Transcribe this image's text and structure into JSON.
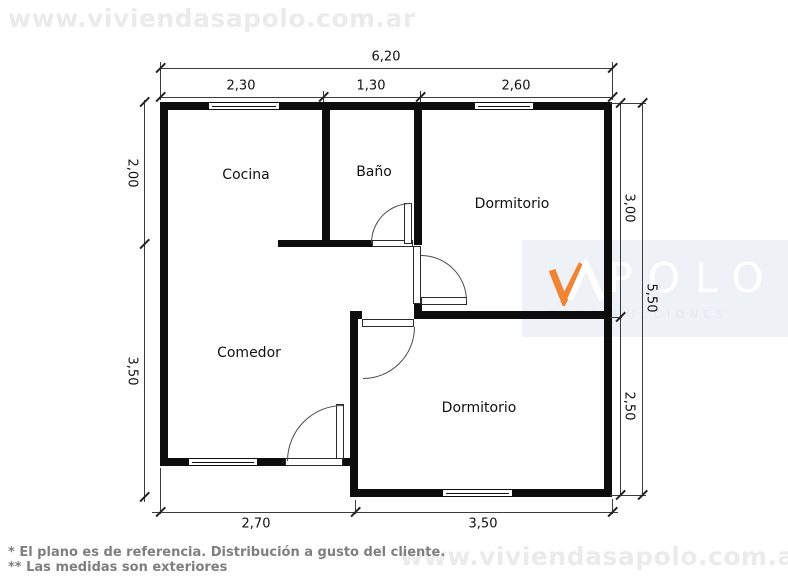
{
  "watermark": {
    "url_text": "www.viviendasapolo.com.ar"
  },
  "logo": {
    "brand": "APOLO",
    "brand_visible_letters": "POLO",
    "tagline": "CONSTRUCCIONES",
    "accent_color": "#EF8532",
    "band_color": "#EEF2F7"
  },
  "rooms": [
    {
      "label": "Cocina"
    },
    {
      "label": "Baño"
    },
    {
      "label": "Dormitorio"
    },
    {
      "label": "Comedor"
    },
    {
      "label": "Dormitorio"
    }
  ],
  "dimensions": {
    "top_total": "6,20",
    "top_segments": [
      "2,30",
      "1,30",
      "2,60"
    ],
    "left": [
      "2,00",
      "3,50"
    ],
    "right": [
      "3,00",
      "2,50"
    ],
    "right_total": "5,50",
    "bottom": [
      "2,70",
      "3,50"
    ]
  },
  "footer": {
    "note1": "* El plano es de referencia. Distribución a gusto del cliente.",
    "note2": "** Las medidas son exteriores"
  },
  "colors": {
    "wall": "#0D0D0D",
    "dimension_line": "#3C3C3C",
    "watermark_text": "#EBEBEB",
    "footer_text": "#7F7F7F"
  }
}
